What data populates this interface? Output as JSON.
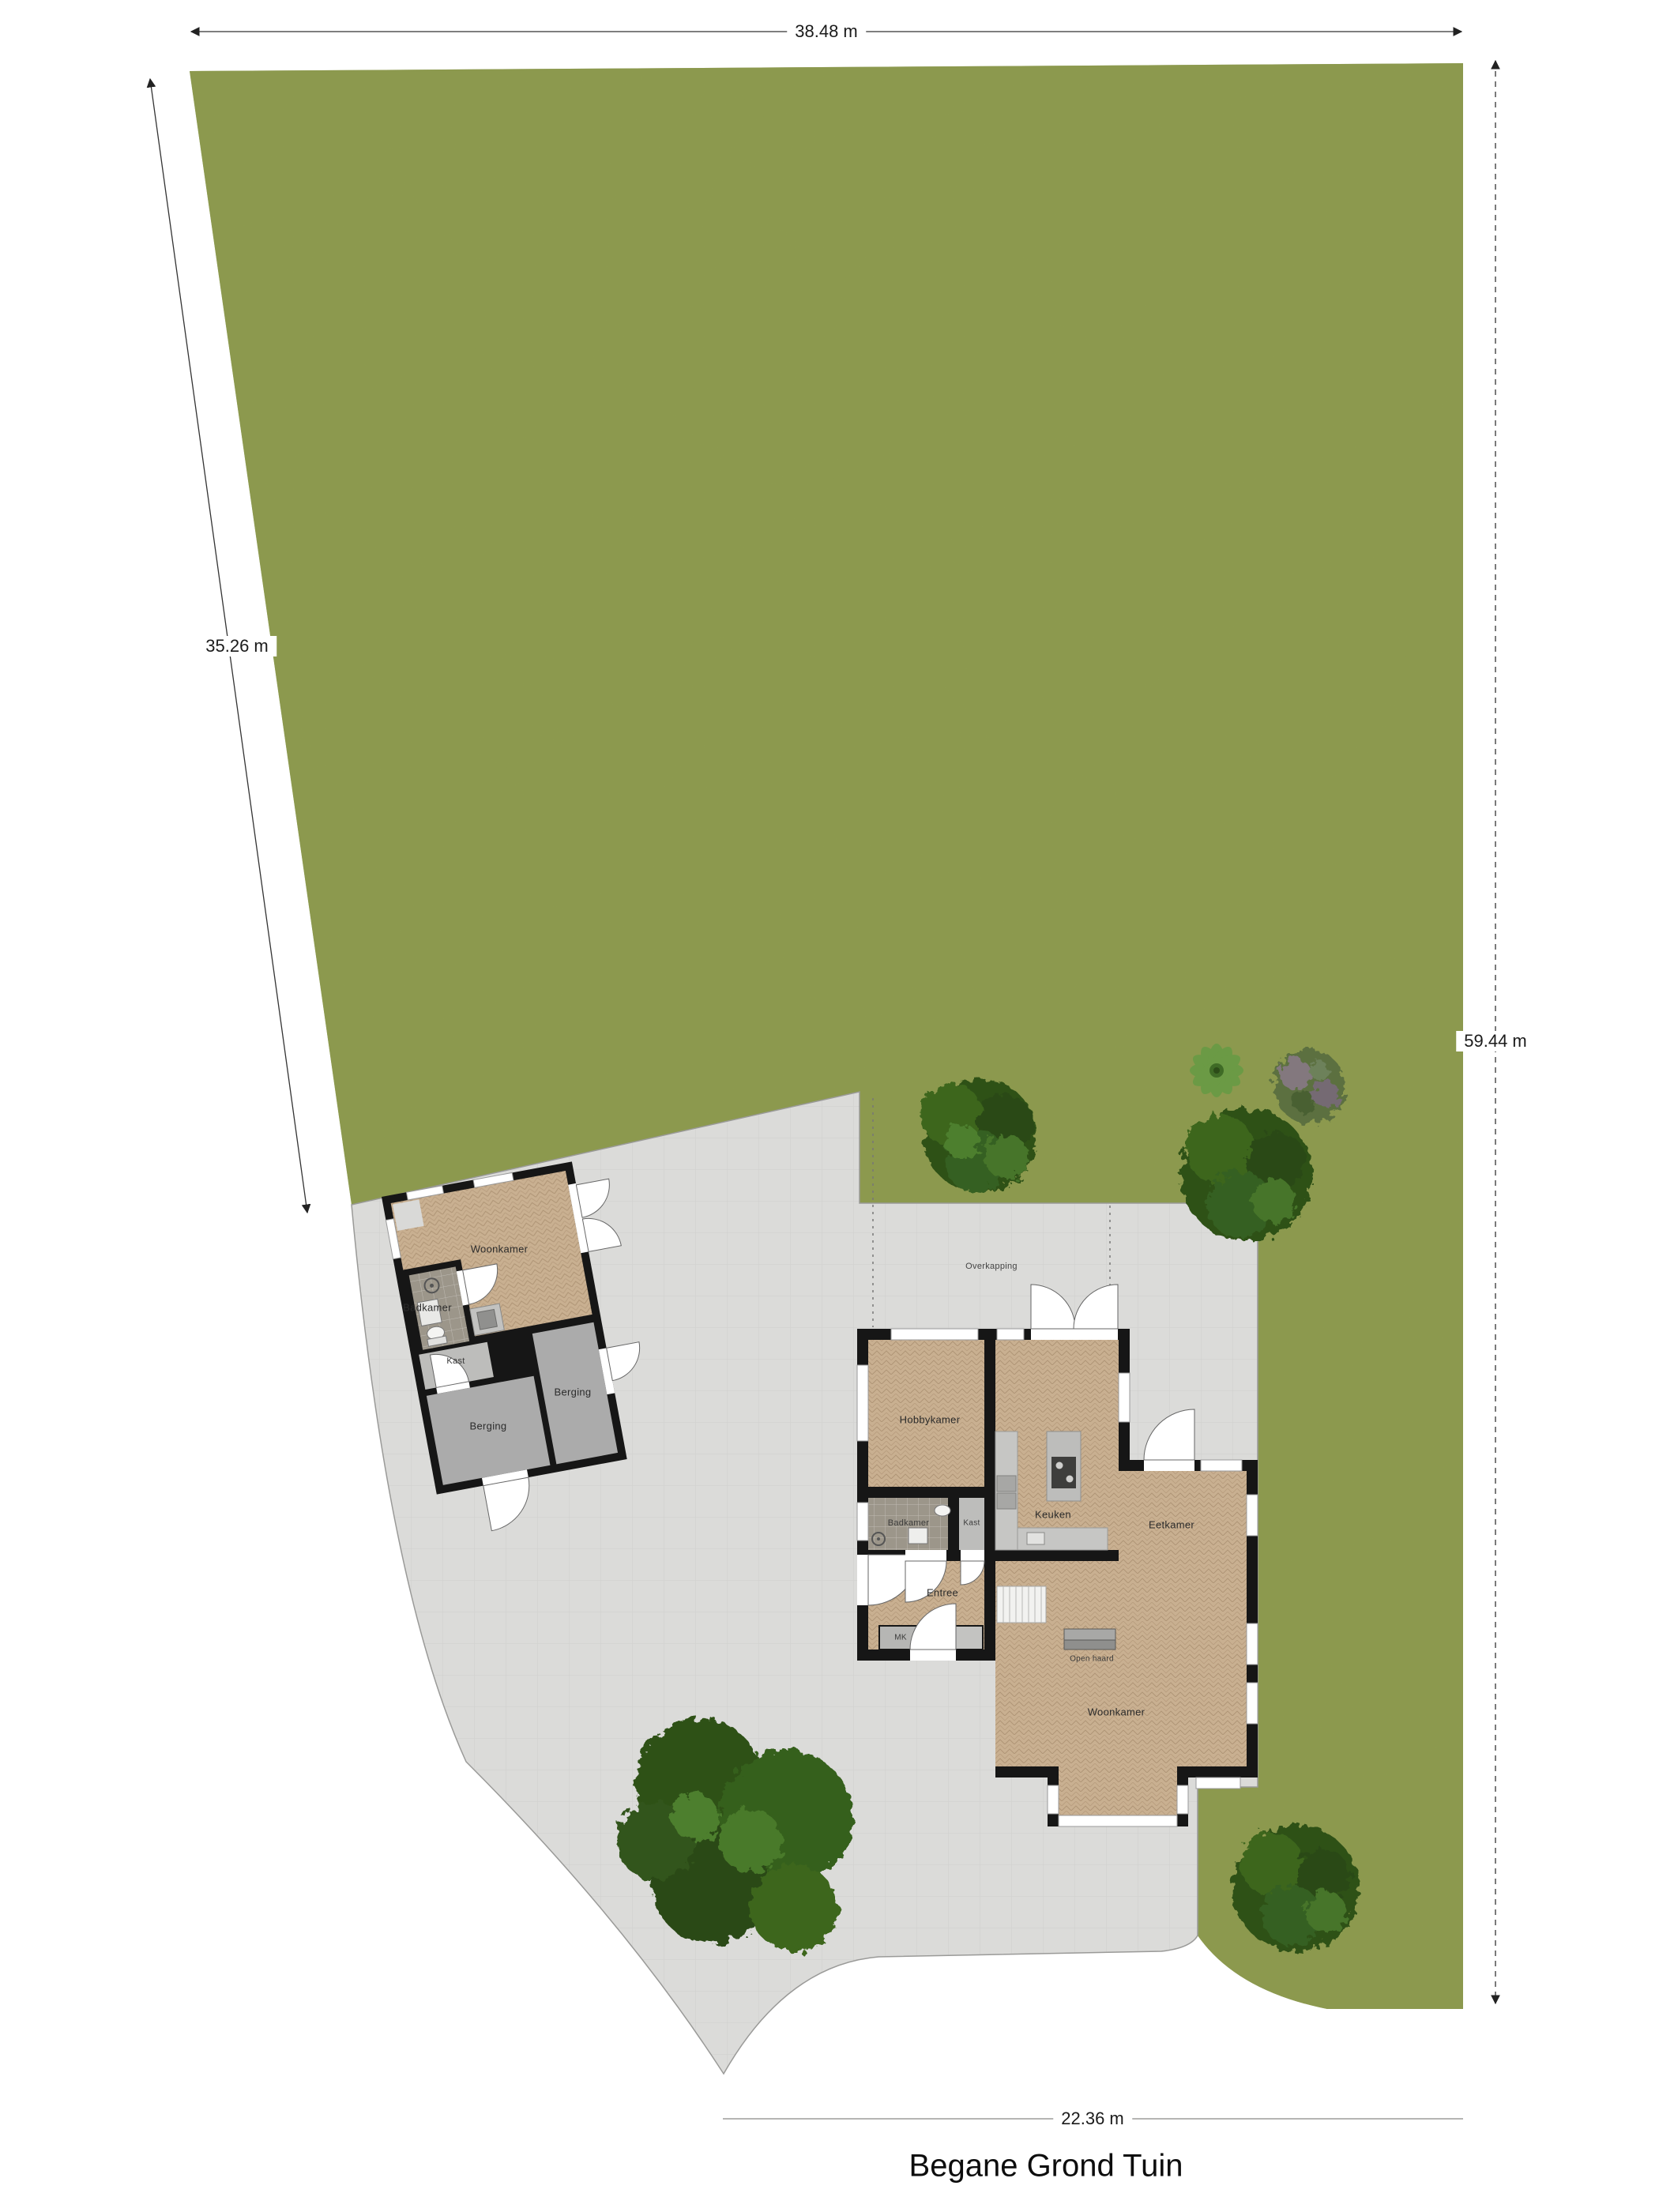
{
  "title": "Begane Grond Tuin",
  "dimensions": {
    "top": "38.48 m",
    "left": "35.26 m",
    "right": "59.44 m",
    "bottom": "22.36 m"
  },
  "site": {
    "overkapping": "Overkapping"
  },
  "outbuilding": {
    "woonkamer": "Woonkamer",
    "badkamer": "Badkamer",
    "kast": "Kast",
    "berging_left": "Berging",
    "berging_right": "Berging"
  },
  "house": {
    "hobbykamer": "Hobbykamer",
    "keuken": "Keuken",
    "badkamer": "Badkamer",
    "kast": "Kast",
    "eetkamer": "Eetkamer",
    "entree": "Entree",
    "mk": "MK",
    "open_haard": "Open haard",
    "woonkamer": "Woonkamer"
  },
  "colors": {
    "grass": "#8d9b53",
    "pavement": "#dbdbd9",
    "wood": "#c9b091",
    "wall": "#161616",
    "tile": "#9c968a",
    "tree": "#31541a"
  }
}
